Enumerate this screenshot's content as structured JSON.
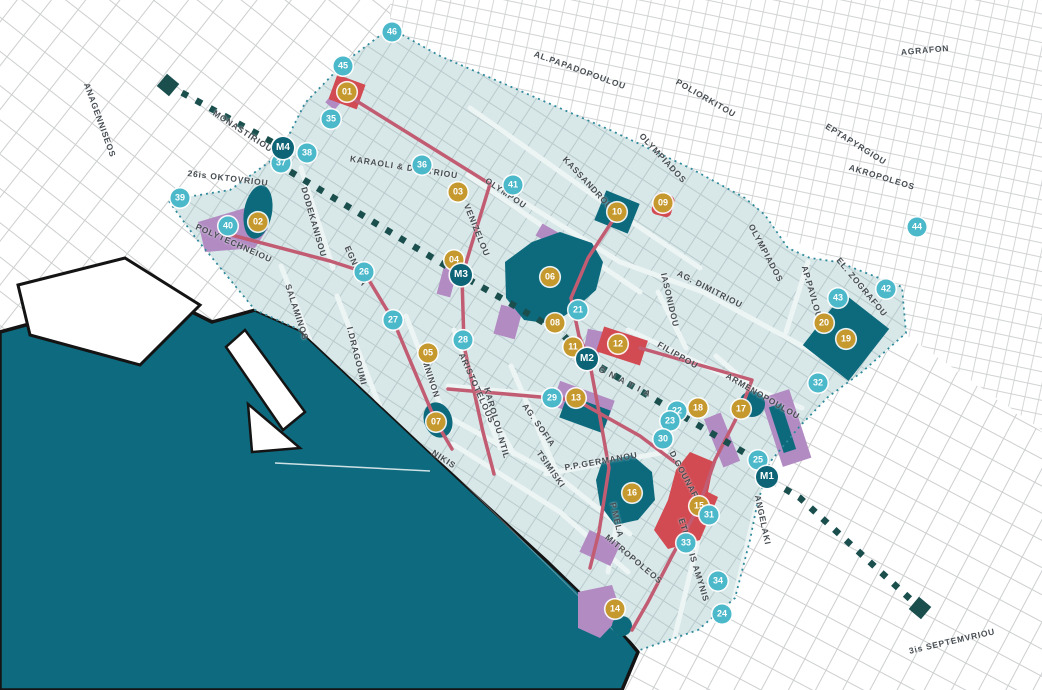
{
  "map_title": "Thessaloniki city centre map",
  "colors": {
    "water": "#0E6A7E",
    "district_fill": "#D8E7E8",
    "site_marker": "#C6992F",
    "attraction_marker": "#4CB9CB",
    "metro_marker": "#0C6476",
    "metro_line": "#1A4F4E",
    "route_line": "#C25C72",
    "landmark_fill": "#0D6A7D",
    "zone_fill": "#B28BC3",
    "highlight_block": "#D24A52",
    "boundary_dots": "#2F8A9B",
    "coastline": "#141414"
  },
  "street_labels": [
    {
      "label": "ANAGENNISEOS",
      "x": 100,
      "y": 120,
      "rot": 70
    },
    {
      "label": "MONASTIRIOU",
      "x": 243,
      "y": 131,
      "rot": 33
    },
    {
      "label": "26is OKTOVRIOU",
      "x": 228,
      "y": 178,
      "rot": 7
    },
    {
      "label": "POLYTECHNEIOU",
      "x": 234,
      "y": 243,
      "rot": 24
    },
    {
      "label": "DODEKANISOU",
      "x": 314,
      "y": 222,
      "rot": 74
    },
    {
      "label": "SALAMINOS",
      "x": 297,
      "y": 312,
      "rot": 72
    },
    {
      "label": "KARAOLI & DIMITRIOU",
      "x": 404,
      "y": 167,
      "rot": 9
    },
    {
      "label": "OLYMPOU",
      "x": 506,
      "y": 193,
      "rot": 34
    },
    {
      "label": "VENIZELOU",
      "x": 477,
      "y": 230,
      "rot": 68
    },
    {
      "label": "KASSANDROU",
      "x": 588,
      "y": 183,
      "rot": 47
    },
    {
      "label": "AL.PAPADOPOULOU",
      "x": 580,
      "y": 70,
      "rot": 20
    },
    {
      "label": "POLIORKITOU",
      "x": 706,
      "y": 98,
      "rot": 30
    },
    {
      "label": "AGRAFON",
      "x": 925,
      "y": 50,
      "rot": -5
    },
    {
      "label": "EPTAPYRGIOU",
      "x": 856,
      "y": 144,
      "rot": 32
    },
    {
      "label": "AKROPOLEOS",
      "x": 882,
      "y": 177,
      "rot": 17
    },
    {
      "label": "OLYMPIADOS",
      "x": 663,
      "y": 158,
      "rot": 47
    },
    {
      "label": "OLYMPIADOS",
      "x": 766,
      "y": 253,
      "rot": 62
    },
    {
      "label": "AG. DIMITRIOU",
      "x": 710,
      "y": 289,
      "rot": 27
    },
    {
      "label": "IASONIDOU",
      "x": 670,
      "y": 300,
      "rot": 77
    },
    {
      "label": "FILIPPOU",
      "x": 678,
      "y": 355,
      "rot": 30
    },
    {
      "label": "AP.PAVLOU",
      "x": 812,
      "y": 292,
      "rot": 74
    },
    {
      "label": "EL. ZOGRAFOU",
      "x": 862,
      "y": 287,
      "rot": 50
    },
    {
      "label": "ARMENOPOULOU",
      "x": 763,
      "y": 396,
      "rot": 30
    },
    {
      "label": "EGNATIA",
      "x": 356,
      "y": 266,
      "rot": 66
    },
    {
      "label": "EGNATIA",
      "x": 622,
      "y": 380,
      "rot": 27,
      "ls": 5
    },
    {
      "label": "I.DRAGOUMI",
      "x": 357,
      "y": 356,
      "rot": 76
    },
    {
      "label": "KOMNINON",
      "x": 429,
      "y": 372,
      "rot": 72
    },
    {
      "label": "ARISTOTELOUS",
      "x": 477,
      "y": 388,
      "rot": 66
    },
    {
      "label": "KAROLOU NTIL",
      "x": 497,
      "y": 423,
      "rot": 74
    },
    {
      "label": "AG. SOFIA",
      "x": 539,
      "y": 425,
      "rot": 55
    },
    {
      "label": "TSIMISKI",
      "x": 551,
      "y": 469,
      "rot": 55
    },
    {
      "label": "P.P.GERMANOU",
      "x": 601,
      "y": 461,
      "rot": -10
    },
    {
      "label": "P.MELA",
      "x": 617,
      "y": 520,
      "rot": 77
    },
    {
      "label": "MITROPOLEOS",
      "x": 634,
      "y": 559,
      "rot": 40
    },
    {
      "label": "D.GOUNARI",
      "x": 685,
      "y": 476,
      "rot": 62
    },
    {
      "label": "ETHNIKIS AMYNIS",
      "x": 694,
      "y": 560,
      "rot": 73
    },
    {
      "label": "ANGELAKI",
      "x": 763,
      "y": 520,
      "rot": 78
    },
    {
      "label": "NIKIS",
      "x": 444,
      "y": 459,
      "rot": 33
    },
    {
      "label": "3is SEPTEMVRIOU",
      "x": 952,
      "y": 641,
      "rot": -13
    }
  ],
  "markers": {
    "sites": [
      {
        "label": "01",
        "x": 347,
        "y": 92
      },
      {
        "label": "02",
        "x": 258,
        "y": 222
      },
      {
        "label": "03",
        "x": 458,
        "y": 192
      },
      {
        "label": "04",
        "x": 454,
        "y": 260
      },
      {
        "label": "05",
        "x": 428,
        "y": 353
      },
      {
        "label": "06",
        "x": 550,
        "y": 277
      },
      {
        "label": "07",
        "x": 436,
        "y": 422
      },
      {
        "label": "08",
        "x": 555,
        "y": 323
      },
      {
        "label": "09",
        "x": 663,
        "y": 203
      },
      {
        "label": "10",
        "x": 617,
        "y": 212
      },
      {
        "label": "11",
        "x": 573,
        "y": 347
      },
      {
        "label": "12",
        "x": 618,
        "y": 344
      },
      {
        "label": "13",
        "x": 576,
        "y": 398
      },
      {
        "label": "14",
        "x": 615,
        "y": 609
      },
      {
        "label": "15",
        "x": 699,
        "y": 506
      },
      {
        "label": "16",
        "x": 632,
        "y": 493
      },
      {
        "label": "17",
        "x": 741,
        "y": 409
      },
      {
        "label": "18",
        "x": 698,
        "y": 408
      },
      {
        "label": "19",
        "x": 846,
        "y": 339
      },
      {
        "label": "20",
        "x": 824,
        "y": 323
      }
    ],
    "attractions": [
      {
        "label": "21",
        "x": 578,
        "y": 310
      },
      {
        "label": "22",
        "x": 677,
        "y": 411
      },
      {
        "label": "23",
        "x": 670,
        "y": 421
      },
      {
        "label": "24",
        "x": 722,
        "y": 614
      },
      {
        "label": "25",
        "x": 758,
        "y": 460
      },
      {
        "label": "26",
        "x": 364,
        "y": 272
      },
      {
        "label": "27",
        "x": 393,
        "y": 320
      },
      {
        "label": "28",
        "x": 463,
        "y": 340
      },
      {
        "label": "29",
        "x": 552,
        "y": 398
      },
      {
        "label": "30",
        "x": 663,
        "y": 439
      },
      {
        "label": "31",
        "x": 709,
        "y": 515
      },
      {
        "label": "32",
        "x": 818,
        "y": 383
      },
      {
        "label": "33",
        "x": 686,
        "y": 543
      },
      {
        "label": "34",
        "x": 718,
        "y": 581
      },
      {
        "label": "35",
        "x": 331,
        "y": 119
      },
      {
        "label": "36",
        "x": 422,
        "y": 165
      },
      {
        "label": "37",
        "x": 281,
        "y": 163
      },
      {
        "label": "38",
        "x": 307,
        "y": 153
      },
      {
        "label": "39",
        "x": 180,
        "y": 198
      },
      {
        "label": "40",
        "x": 228,
        "y": 226
      },
      {
        "label": "41",
        "x": 513,
        "y": 185
      },
      {
        "label": "42",
        "x": 886,
        "y": 289
      },
      {
        "label": "43",
        "x": 838,
        "y": 298
      },
      {
        "label": "44",
        "x": 917,
        "y": 227
      },
      {
        "label": "45",
        "x": 343,
        "y": 66
      },
      {
        "label": "46",
        "x": 392,
        "y": 32
      }
    ],
    "metro_stations": [
      {
        "label": "M1",
        "x": 767,
        "y": 477
      },
      {
        "label": "M2",
        "x": 587,
        "y": 359
      },
      {
        "label": "M3",
        "x": 461,
        "y": 275
      },
      {
        "label": "M4",
        "x": 283,
        "y": 148
      }
    ]
  }
}
